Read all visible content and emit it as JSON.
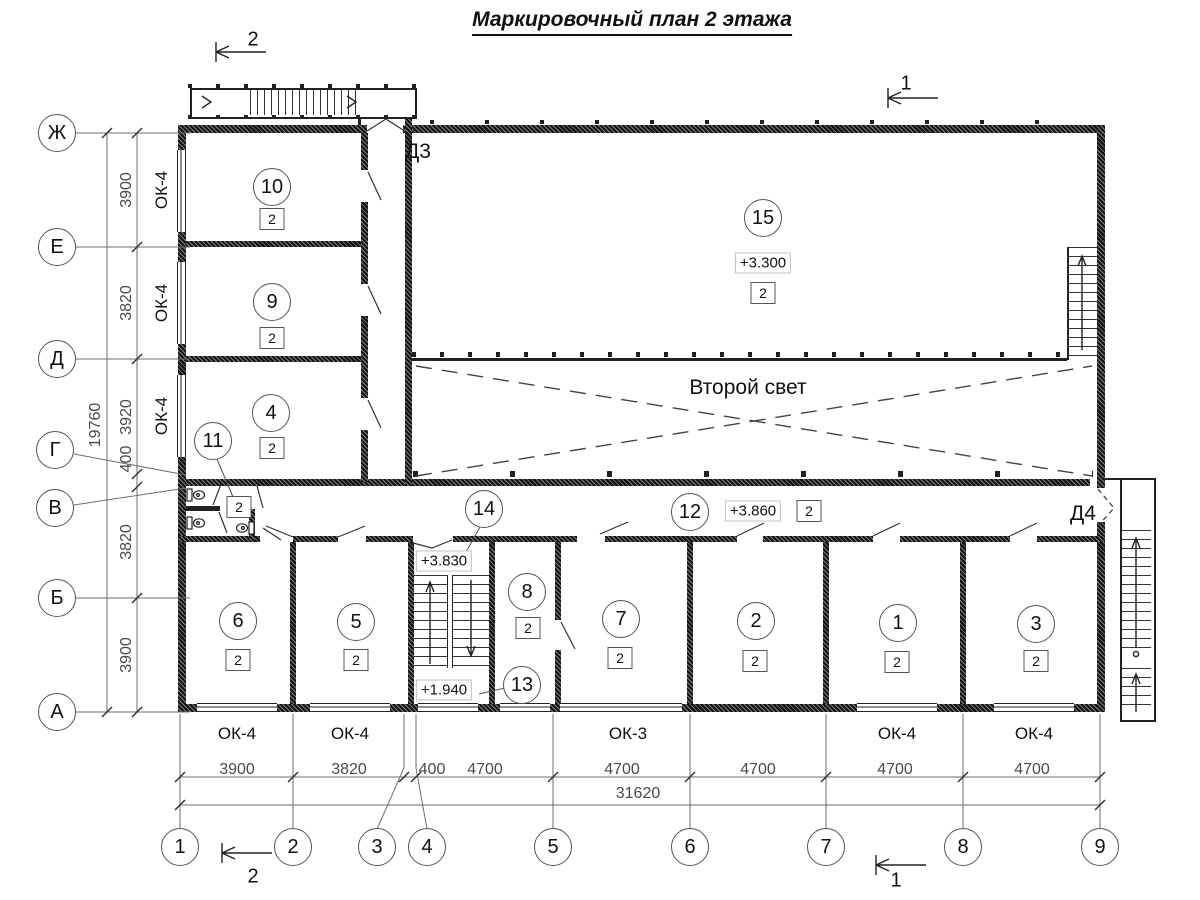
{
  "title": "Маркировочный план 2 этажа",
  "void_label": "Второй свет",
  "axes": {
    "left": [
      {
        "label": "Ж",
        "x": 57,
        "y": 133
      },
      {
        "label": "Е",
        "x": 57,
        "y": 247
      },
      {
        "label": "Д",
        "x": 57,
        "y": 359
      },
      {
        "label": "Г",
        "x": 55,
        "y": 450
      },
      {
        "label": "В",
        "x": 55,
        "y": 508
      },
      {
        "label": "Б",
        "x": 57,
        "y": 598
      },
      {
        "label": "А",
        "x": 57,
        "y": 712
      }
    ],
    "bottom": [
      {
        "label": "1",
        "x": 180,
        "y": 847
      },
      {
        "label": "2",
        "x": 293,
        "y": 847
      },
      {
        "label": "3",
        "x": 377,
        "y": 847
      },
      {
        "label": "4",
        "x": 427,
        "y": 847
      },
      {
        "label": "5",
        "x": 553,
        "y": 847
      },
      {
        "label": "6",
        "x": 690,
        "y": 847
      },
      {
        "label": "7",
        "x": 826,
        "y": 847
      },
      {
        "label": "8",
        "x": 963,
        "y": 847
      },
      {
        "label": "9",
        "x": 1100,
        "y": 847
      }
    ]
  },
  "dimensions": {
    "left": [
      {
        "value": "3900",
        "x": 127,
        "y": 190
      },
      {
        "value": "3820",
        "x": 127,
        "y": 303
      },
      {
        "value": "3920",
        "x": 127,
        "y": 417
      },
      {
        "value": "400",
        "x": 127,
        "y": 459
      },
      {
        "value": "3820",
        "x": 127,
        "y": 542
      },
      {
        "value": "3900",
        "x": 127,
        "y": 655
      }
    ],
    "left_total": {
      "value": "19760",
      "x": 96,
      "y": 425
    },
    "bottom": [
      {
        "value": "3900",
        "x": 237,
        "y": 770
      },
      {
        "value": "3820",
        "x": 349,
        "y": 770
      },
      {
        "value": "400",
        "x": 432,
        "y": 770
      },
      {
        "value": "4700",
        "x": 485,
        "y": 770
      },
      {
        "value": "4700",
        "x": 622,
        "y": 770
      },
      {
        "value": "4700",
        "x": 758,
        "y": 770
      },
      {
        "value": "4700",
        "x": 895,
        "y": 770
      },
      {
        "value": "4700",
        "x": 1032,
        "y": 770
      }
    ],
    "bottom_total": {
      "value": "31620",
      "x": 638,
      "y": 794
    }
  },
  "rooms": [
    {
      "number": "10",
      "type": "2",
      "cx": 272,
      "cy": 187,
      "sq": [
        272,
        219
      ]
    },
    {
      "number": "9",
      "type": "2",
      "cx": 272,
      "cy": 302,
      "sq": [
        272,
        338
      ]
    },
    {
      "number": "4",
      "type": "2",
      "cx": 271,
      "cy": 413,
      "sq": [
        272,
        448
      ]
    },
    {
      "number": "11",
      "type": "2",
      "cx": 213,
      "cy": 441,
      "sq": [
        239,
        507
      ]
    },
    {
      "number": "15",
      "type": "2",
      "cx": 763,
      "cy": 218,
      "sq": [
        763,
        293
      ]
    },
    {
      "number": "14",
      "type": null,
      "cx": 484,
      "cy": 509,
      "sq": null
    },
    {
      "number": "13",
      "type": null,
      "cx": 522,
      "cy": 685,
      "sq": null
    },
    {
      "number": "12",
      "type": "2",
      "cx": 690,
      "cy": 512,
      "sq": [
        809,
        511
      ]
    },
    {
      "number": "8",
      "type": "2",
      "cx": 527,
      "cy": 592,
      "sq": [
        528,
        628
      ]
    },
    {
      "number": "7",
      "type": "2",
      "cx": 621,
      "cy": 619,
      "sq": [
        620,
        658
      ]
    },
    {
      "number": "6",
      "type": "2",
      "cx": 238,
      "cy": 621,
      "sq": [
        238,
        660
      ]
    },
    {
      "number": "5",
      "type": "2",
      "cx": 356,
      "cy": 622,
      "sq": [
        356,
        660
      ]
    },
    {
      "number": "2",
      "type": "2",
      "cx": 756,
      "cy": 621,
      "sq": [
        755,
        661
      ]
    },
    {
      "number": "1",
      "type": "2",
      "cx": 898,
      "cy": 623,
      "sq": [
        897,
        662
      ]
    },
    {
      "number": "3",
      "type": "2",
      "cx": 1036,
      "cy": 624,
      "sq": [
        1036,
        661
      ]
    }
  ],
  "elevations": [
    {
      "value": "+3.300",
      "x": 763,
      "y": 263
    },
    {
      "value": "+3.860",
      "x": 753,
      "y": 511
    },
    {
      "value": "+3.830",
      "x": 444,
      "y": 561
    },
    {
      "value": "+1.940",
      "x": 444,
      "y": 690
    }
  ],
  "windows": {
    "left": [
      {
        "label": "ОК-4",
        "x": 162,
        "y": 190
      },
      {
        "label": "ОК-4",
        "x": 162,
        "y": 303
      },
      {
        "label": "ОК-4",
        "x": 162,
        "y": 416
      }
    ],
    "bottom": [
      {
        "label": "ОК-4",
        "x": 237,
        "y": 734
      },
      {
        "label": "ОК-4",
        "x": 350,
        "y": 734
      },
      {
        "label": "ОК-3",
        "x": 628,
        "y": 734
      },
      {
        "label": "ОК-4",
        "x": 897,
        "y": 734
      },
      {
        "label": "ОК-4",
        "x": 1034,
        "y": 734
      }
    ]
  },
  "doors": [
    {
      "label": "Д3",
      "x": 418,
      "y": 152
    },
    {
      "label": "Д4",
      "x": 1083,
      "y": 514
    }
  ],
  "sections": [
    {
      "label": "2",
      "x": 253,
      "y": 40
    },
    {
      "label": "1",
      "x": 906,
      "y": 84
    },
    {
      "label": "2",
      "x": 253,
      "y": 877
    },
    {
      "label": "1",
      "x": 896,
      "y": 881
    }
  ]
}
